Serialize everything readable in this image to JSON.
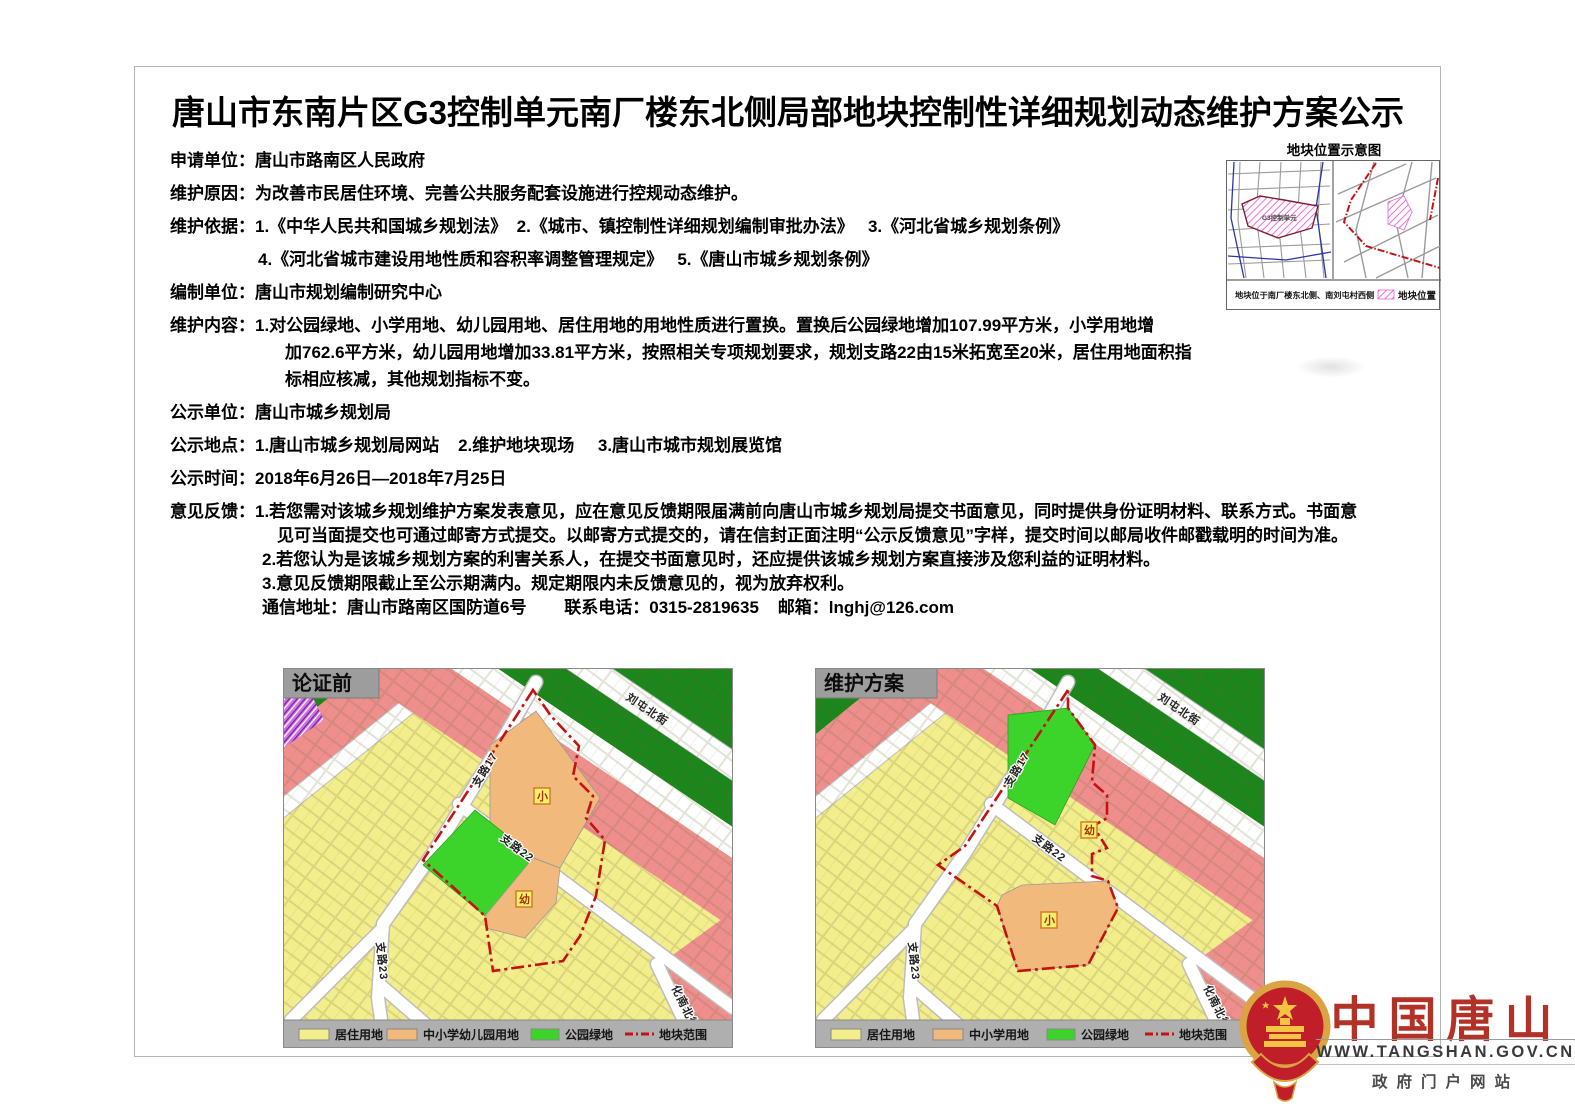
{
  "doc": {
    "title": "唐山市东南片区G3控制单元南厂楼东北侧局部地块控制性详细规划动态维护方案公示",
    "lines": [
      {
        "label": "申请单位：",
        "text": "唐山市路南区人民政府"
      },
      {
        "label": "维护原因：",
        "text": "为改善市民居住环境、完善公共服务配套设施进行控规动态维护。"
      },
      {
        "label": "维护依据：",
        "text": "1.《中华人民共和国城乡规划法》  2.《城市、镇控制性详细规划编制审批办法》   3.《河北省城乡规划条例》"
      },
      {
        "label": "",
        "text": "4.《河北省城市建设用地性质和容积率调整管理规定》   5.《唐山市城乡规划条例》"
      },
      {
        "label": "编制单位：",
        "text": "唐山市规划编制研究中心"
      },
      {
        "label": "维护内容：",
        "text": "1.对公园绿地、小学用地、幼儿园用地、居住用地的用地性质进行置换。置换后公园绿地增加107.99平方米，小学用地增"
      },
      {
        "label": "",
        "text": "加762.6平方米，幼儿园用地增加33.81平方米，按照相关专项规划要求，规划支路22由15米拓宽至20米，居住用地面积指"
      },
      {
        "label": "",
        "text": "标相应核减，其他规划指标不变。"
      },
      {
        "label": "公示单位：",
        "text": "唐山市城乡规划局"
      },
      {
        "label": "公示地点：",
        "text": "1.唐山市城乡规划局网站    2.维护地块现场     3.唐山市城市规划展览馆"
      },
      {
        "label": "公示时间：",
        "text": "2018年6月26日—2018年7月25日"
      },
      {
        "label": "意见反馈：",
        "text": "1.若您需对该城乡规划维护方案发表意见，应在意见反馈期限届满前向唐山市城乡规划局提交书面意见，同时提供身份证明材料、联系方式。书面意"
      },
      {
        "label": "",
        "text": "见可当面提交也可通过邮寄方式提交。以邮寄方式提交的，请在信封正面注明“公示反馈意见”字样，提交时间以邮局收件邮戳载明的时间为准。"
      },
      {
        "label": "",
        "text": "2.若您认为是该城乡规划方案的利害关系人，在提交书面意见时，还应提供该城乡规划方案直接涉及您利益的证明材料。"
      },
      {
        "label": "",
        "text": "3.意见反馈期限截止至公示期满内。规定期限内未反馈意见的，视为放弃权利。"
      },
      {
        "label": "",
        "text": "通信地址：唐山市路南区国防道6号        联系电话：0315-2819635    邮箱：lnghj@126.com"
      }
    ]
  },
  "inset": {
    "title": "地块位置示意图",
    "area_label": "G3控制单元",
    "caption": "地块位于南厂楼东北侧、南刘屯村西侧",
    "legend_label": "地块位置"
  },
  "maps": {
    "before": {
      "title": "论证前",
      "roads": {
        "r17": "支路17",
        "r22": "支路22",
        "r23": "支路23",
        "liutun": "刘屯北街",
        "huanan": "化南北街"
      },
      "zones": {
        "xiao": "小",
        "you": "幼"
      },
      "legend": [
        {
          "label": "居住用地",
          "color": "#F3EE8C"
        },
        {
          "label": "中小学幼儿园用地",
          "color": "#F1B97B"
        },
        {
          "label": "公园绿地",
          "color": "#3CD32A"
        },
        {
          "label": "地块范围",
          "color": "#C51111"
        }
      ]
    },
    "plan": {
      "title": "维护方案",
      "roads": {
        "r17": "支路17",
        "r22": "支路22",
        "r23": "支路23",
        "liutun": "刘屯北街",
        "huanan": "化南北街"
      },
      "zones": {
        "xiao": "小",
        "you": "幼"
      },
      "legend": [
        {
          "label": "居住用地",
          "color": "#F3EE8C"
        },
        {
          "label": "中小学用地",
          "color": "#F1B97B"
        },
        {
          "label": "公园绿地",
          "color": "#3CD32A"
        },
        {
          "label": "地块范围",
          "color": "#C51111"
        }
      ]
    }
  },
  "footer": {
    "brand": "中国唐山",
    "url": "WWW.TANGSHAN.GOV.CN",
    "tagline": "政府门户网站"
  },
  "colors": {
    "residential": "#F3EE8C",
    "school": "#F1B97B",
    "park_green": "#3CD32A",
    "green_belt": "#1B861B",
    "pink_band": "#EE8F8D",
    "boundary_red": "#C51111",
    "legend_bar": "#AFAFAF",
    "brand_red": "#B23228"
  }
}
